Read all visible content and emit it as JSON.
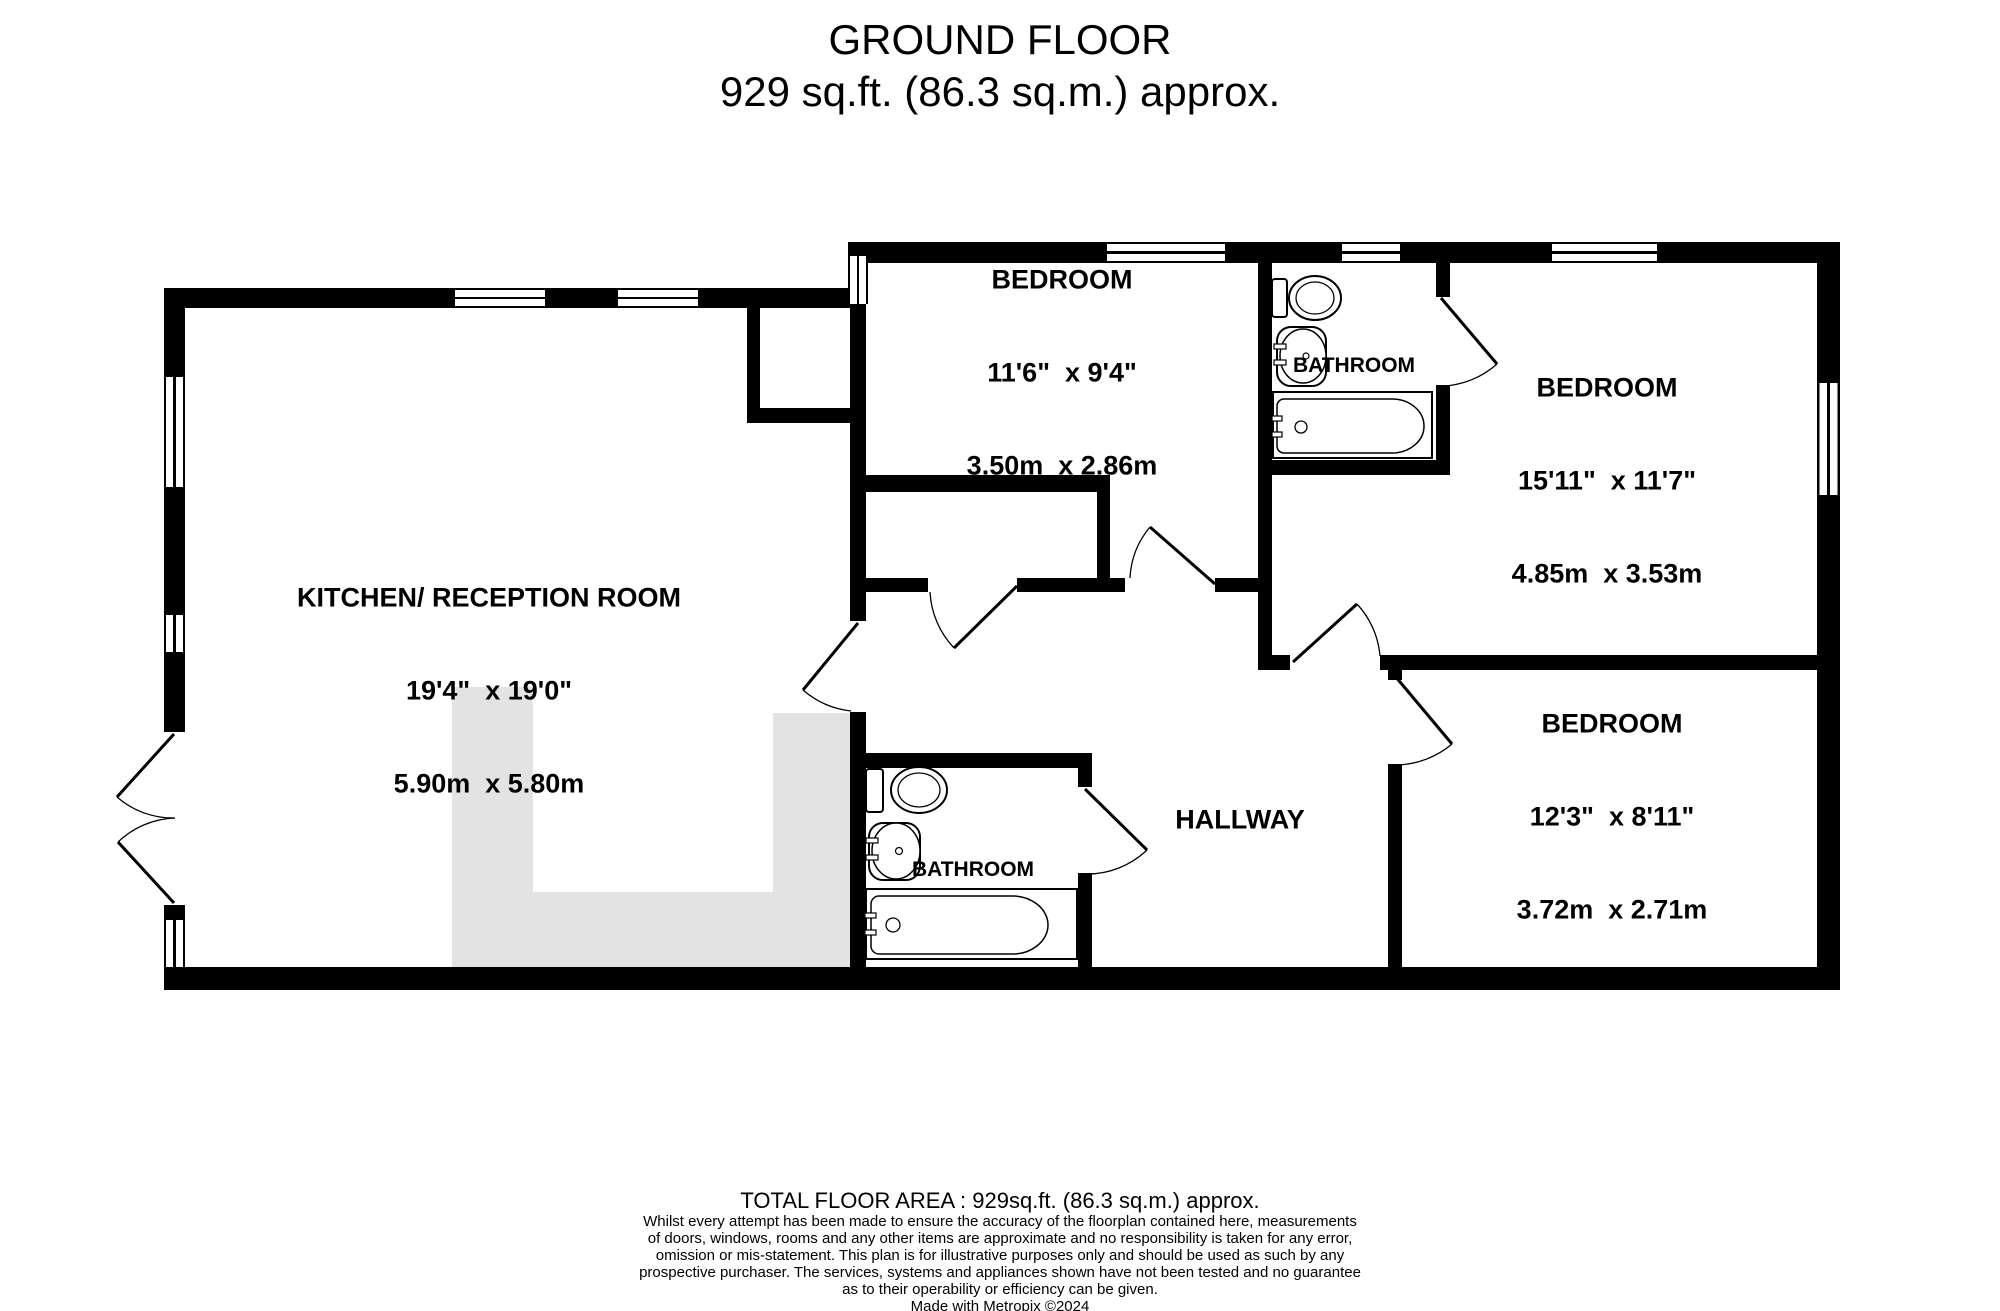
{
  "title": {
    "line1": "GROUND FLOOR",
    "line2": "929 sq.ft. (86.3 sq.m.) approx."
  },
  "rooms": {
    "kitchen": {
      "name": "KITCHEN/ RECEPTION ROOM",
      "dim_imperial": "19'4\"  x 19'0\"",
      "dim_metric": "5.90m  x 5.80m"
    },
    "bedroom1": {
      "name": "BEDROOM",
      "dim_imperial": "11'6\"  x 9'4\"",
      "dim_metric": "3.50m  x 2.86m"
    },
    "bedroom2": {
      "name": "BEDROOM",
      "dim_imperial": "15'11\"  x 11'7\"",
      "dim_metric": "4.85m  x 3.53m"
    },
    "bedroom3": {
      "name": "BEDROOM",
      "dim_imperial": "12'3\"  x 8'11\"",
      "dim_metric": "3.72m  x 2.71m"
    },
    "hallway": {
      "name": "HALLWAY"
    },
    "bathroom_top": {
      "name": "BATHROOM"
    },
    "bathroom_bottom": {
      "name": "BATHROOM"
    }
  },
  "footer": {
    "total_area": "TOTAL FLOOR AREA : 929sq.ft. (86.3 sq.m.) approx.",
    "disclaimer": [
      "Whilst every attempt has been made to ensure the accuracy of the floorplan contained here, measurements",
      "of doors, windows, rooms and any other items are approximate and no responsibility is taken for any error,",
      "omission or mis-statement. This plan is for illustrative purposes only and should be used as such by any",
      "prospective purchaser. The services, systems and appliances shown have not been tested and no guarantee",
      "as to their operability or efficiency can be given."
    ],
    "made_with": "Made with Metropix ©2024"
  },
  "colors": {
    "wall": "#000000",
    "background": "#ffffff",
    "kitchen_counter_gray": "#e3e3e3"
  }
}
